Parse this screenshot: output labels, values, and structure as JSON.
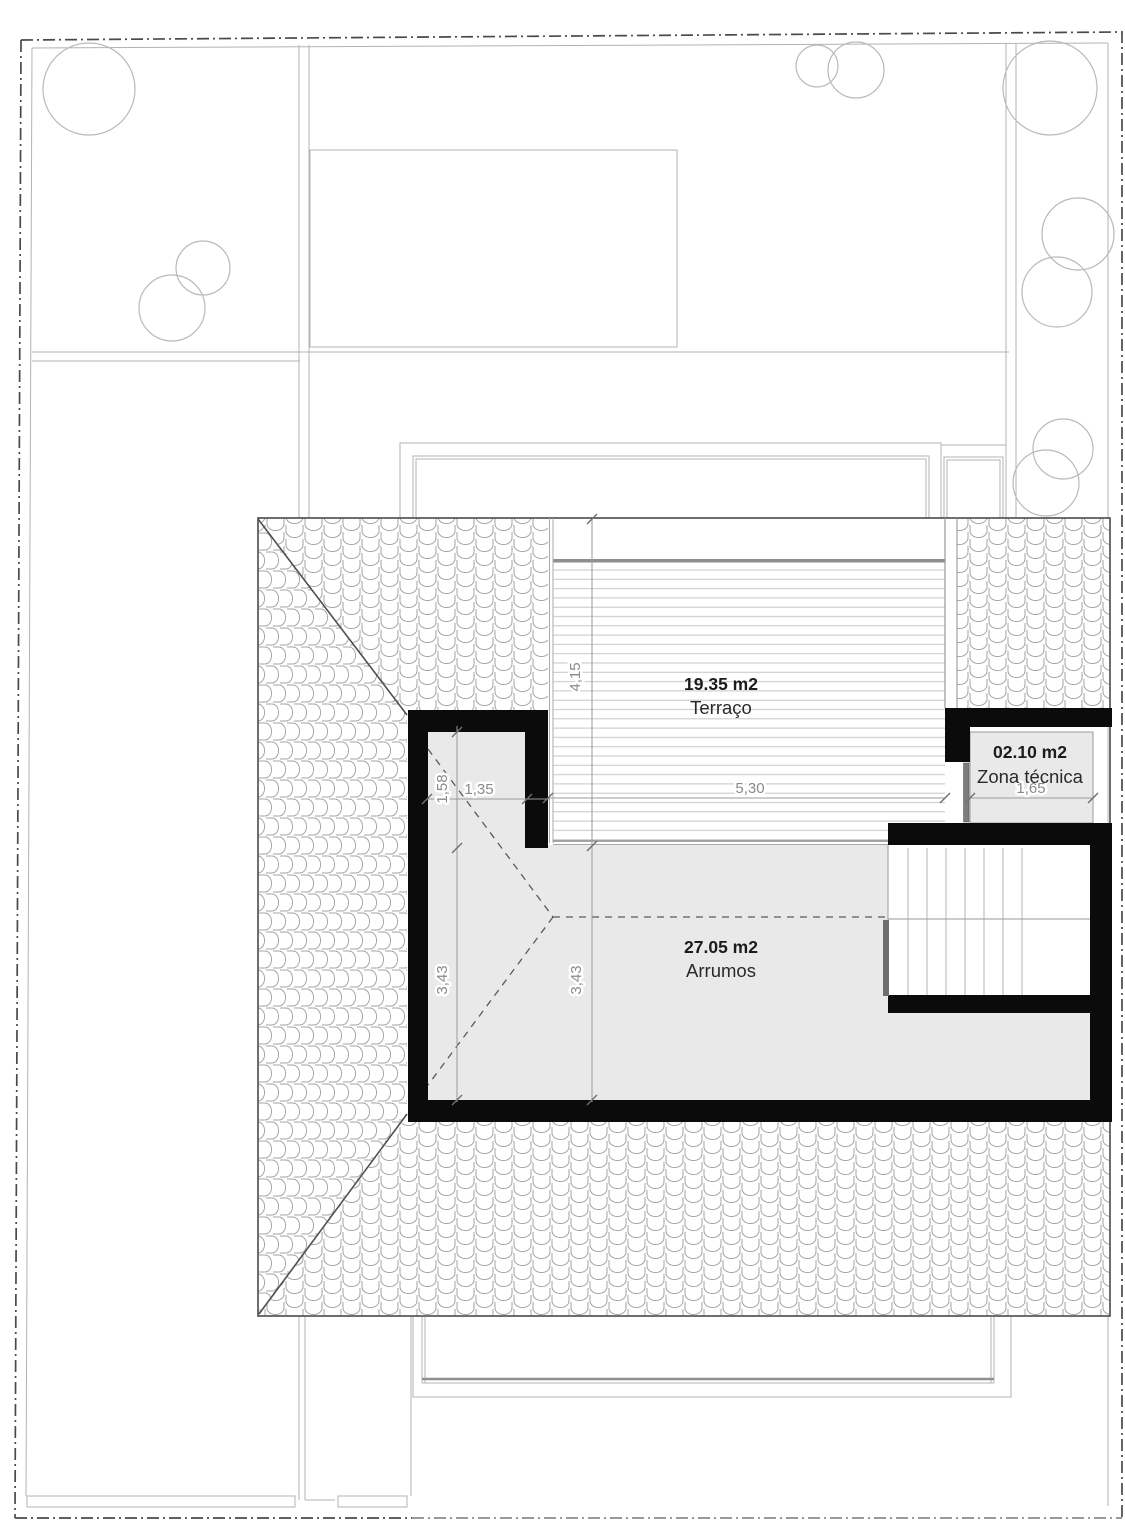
{
  "plan": {
    "rooms": [
      {
        "id": "terraco",
        "area_label": "19.35 m2",
        "name": "Terraço"
      },
      {
        "id": "zona_tecnica",
        "area_label": "02.10 m2",
        "name": "Zona técnica"
      },
      {
        "id": "arrumos",
        "area_label": "27.05 m2",
        "name": "Arrumos"
      }
    ],
    "dimensions": {
      "terrace_depth": "4,15",
      "terrace_width": "5,30",
      "zona_tecnica_width": "1,65",
      "notch_width": "1,35",
      "notch_depth": "1,58",
      "arrumos_depth_left": "3,43",
      "arrumos_depth_inner": "3,43"
    },
    "colors": {
      "wall": "#0b0b0b",
      "room_fill": "#e9e9e9",
      "roof_line": "#9f9f9f",
      "dimension_text": "#8a8a8a",
      "label_text": "#1c1c1c",
      "boundary": "#4a4a4a"
    }
  }
}
